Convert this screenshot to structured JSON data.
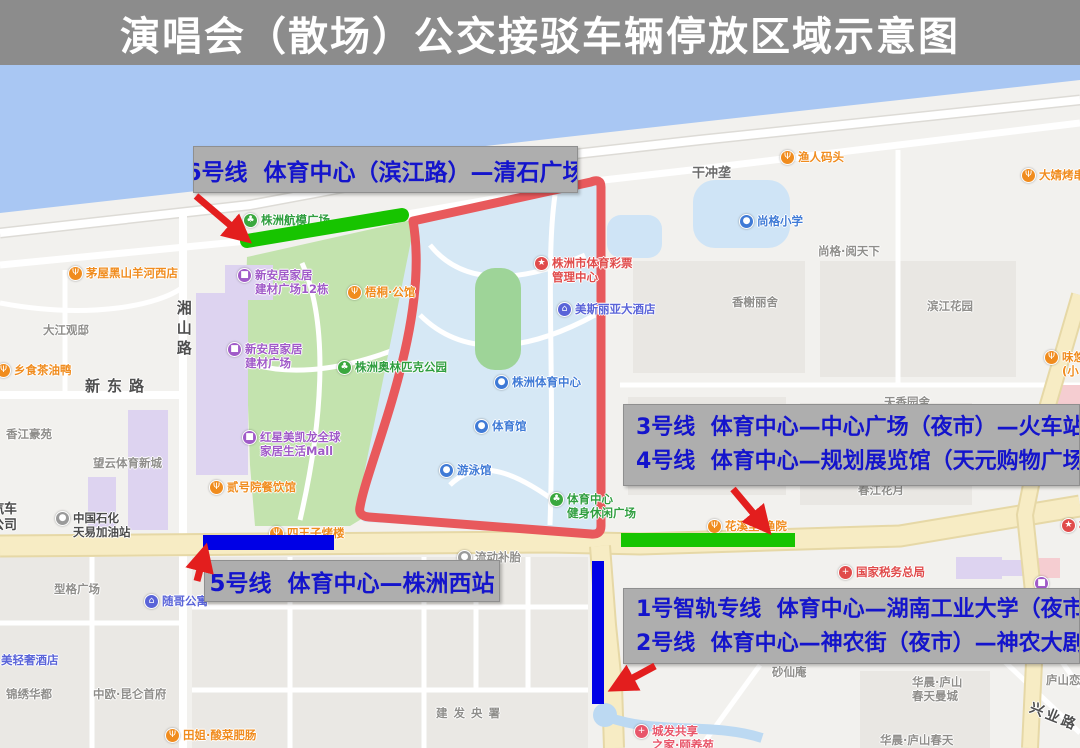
{
  "title": "演唱会（散场）公交接驳车辆停放区域示意图",
  "colors": {
    "title_bg": "#8c8c8c",
    "annotation_box_bg": "#aeaeae",
    "annotation_text": "#1414cc",
    "route_green": "#17c400",
    "route_blue": "#0000e6",
    "route_red_zone": "#e8595c",
    "arrow_red": "#e31e1e",
    "river_blue": "#a9c7f3",
    "park_green": "#c3e3ae",
    "stadium_blue": "#d6e8f5",
    "field_green": "#9ed498",
    "road_yellow": "#f7ecc4",
    "building_purple": "#ddd3f0",
    "building_pink": "#f5cdd1",
    "poi_orange": "#f08c1e",
    "poi_blue": "#3f7ad6",
    "poi_green": "#3aa83e",
    "poi_purple": "#a05ac8",
    "poi_red": "#e04b4b"
  },
  "annotations": {
    "line6": {
      "text": "6号线  体育中心（滨江路）—清石广场"
    },
    "line34": {
      "line1": "3号线  体育中心—中心广场（夜市）—火车站",
      "line2": "4号线  体育中心—规划展览馆（天元购物广场）"
    },
    "line5": {
      "text": "5号线  体育中心—株洲西站"
    },
    "line12": {
      "line1": "1号智轨专线  体育中心—湖南工业大学（夜市）",
      "line2": "2号线  体育中心—神农街（夜市）—神农大剧院"
    }
  },
  "map": {
    "labels": [
      {
        "n": "poi-aeromodel-plaza",
        "x": 243,
        "y": 148,
        "c": "#3aa83e",
        "g": "♣",
        "l": [
          "株洲航模广场"
        ],
        "tc": "#2f9e3f"
      },
      {
        "n": "poi-maowu-blackgoat-restaurant",
        "x": 68,
        "y": 201,
        "c": "#f08c1e",
        "g": "Ψ",
        "l": [
          "茅屋黑山羊河西店"
        ],
        "tc": "#f08c1e"
      },
      {
        "n": "poi-xiangshi-tea-oil-duck",
        "x": -4,
        "y": 298,
        "c": "#f08c1e",
        "g": "Ψ",
        "l": [
          "乡食茶油鸭"
        ],
        "tc": "#f08c1e"
      },
      {
        "n": "label-dajiang-guandi",
        "x": 43,
        "y": 258,
        "l": [
          "大江观邸"
        ],
        "tc": "#8f8e8b"
      },
      {
        "n": "label-xiangshan-road",
        "x": 174,
        "y": 235,
        "l": [
          "湘山路"
        ],
        "tc": "#4f4f4f",
        "fs": 15,
        "vert": true
      },
      {
        "n": "label-xindong-road",
        "x": 85,
        "y": 312,
        "l": [
          "新东路"
        ],
        "tc": "#4f4f4f",
        "fs": 15,
        "ls": 7
      },
      {
        "n": "poi-xinanju-12dong",
        "x": 237,
        "y": 203,
        "c": "#a05ac8",
        "g": "■",
        "l": [
          "新安居家居",
          "建材广场12栋"
        ],
        "tc": "#a05ac8"
      },
      {
        "n": "poi-wutong-mansion",
        "x": 347,
        "y": 220,
        "c": "#f08c1e",
        "g": "Ψ",
        "l": [
          "梧桐·公馆"
        ],
        "tc": "#f08c1e"
      },
      {
        "n": "poi-xinanju",
        "x": 227,
        "y": 277,
        "c": "#a05ac8",
        "g": "■",
        "l": [
          "新安居家居",
          "建材广场"
        ],
        "tc": "#a05ac8"
      },
      {
        "n": "poi-olympic-park",
        "x": 337,
        "y": 295,
        "c": "#3aa83e",
        "g": "♣",
        "l": [
          "株洲奥林匹克公园"
        ],
        "tc": "#2f9e3f"
      },
      {
        "n": "poi-macalline-mall",
        "x": 242,
        "y": 365,
        "c": "#a05ac8",
        "g": "■",
        "l": [
          "红星美凯龙全球",
          "家居生活Mall"
        ],
        "tc": "#a05ac8"
      },
      {
        "n": "poi-sports-lottery-center",
        "x": 534,
        "y": 191,
        "c": "#e04b4b",
        "g": "★",
        "l": [
          "株洲市体育彩票",
          "管理中心"
        ],
        "tc": "#e04b4b"
      },
      {
        "n": "poi-meisiliya-hotel",
        "x": 557,
        "y": 237,
        "c": "#5a64d8",
        "g": "⌂",
        "l": [
          "美斯丽亚大酒店"
        ],
        "tc": "#5a64d8"
      },
      {
        "n": "poi-zhuzhou-sports-center",
        "x": 494,
        "y": 310,
        "c": "#3f7ad6",
        "g": "●",
        "l": [
          "株洲体育中心"
        ],
        "tc": "#3f7ad6"
      },
      {
        "n": "poi-gymnasium",
        "x": 474,
        "y": 354,
        "c": "#3f7ad6",
        "g": "●",
        "l": [
          "体育馆"
        ],
        "tc": "#3f7ad6"
      },
      {
        "n": "poi-swimming-pool",
        "x": 439,
        "y": 398,
        "c": "#3f7ad6",
        "g": "●",
        "l": [
          "游泳馆"
        ],
        "tc": "#3f7ad6"
      },
      {
        "n": "poi-fitness-leisure-plaza",
        "x": 549,
        "y": 427,
        "c": "#3aa83e",
        "g": "♣",
        "l": [
          "体育中心",
          "健身休闲广场"
        ],
        "tc": "#2f9e3f"
      },
      {
        "n": "poi-siwangzi-restaurant",
        "x": 269,
        "y": 461,
        "c": "#f08c1e",
        "g": "Ψ",
        "l": [
          "四王子烤楼"
        ],
        "tc": "#f08c1e"
      },
      {
        "n": "poi-sinopec-gas-station",
        "x": 55,
        "y": 446,
        "c": "#9a9a9a",
        "g": "●",
        "l": [
          "中国石化",
          "天易加油站"
        ],
        "tc": "#4a4a4a"
      },
      {
        "n": "label-auto-company-partial",
        "x": -9,
        "y": 437,
        "l": [
          "汽车",
          "公司"
        ],
        "tc": "#4a4a4a",
        "fs": 13
      },
      {
        "n": "label-xiangjiang-haoyuan",
        "x": 6,
        "y": 362,
        "l": [
          "香江豪苑"
        ],
        "tc": "#8f8e8b"
      },
      {
        "n": "label-wangyun-sports-town",
        "x": 93,
        "y": 391,
        "l": [
          "望云体育新城"
        ],
        "tc": "#8f8e8b"
      },
      {
        "n": "poi-erhaoyuan-restaurant",
        "x": 209,
        "y": 415,
        "c": "#f08c1e",
        "g": "Ψ",
        "l": [
          "贰号院餐饮馆"
        ],
        "tc": "#f08c1e"
      },
      {
        "n": "label-xingge-plaza",
        "x": 54,
        "y": 517,
        "l": [
          "型格广场"
        ],
        "tc": "#8f8e8b"
      },
      {
        "n": "poi-suige-apartment",
        "x": 144,
        "y": 529,
        "c": "#5a64d8",
        "g": "⌂",
        "l": [
          "随哥公寓"
        ],
        "tc": "#5a64d8"
      },
      {
        "n": "label-meiqingshe-hotel",
        "x": 1,
        "y": 588,
        "l": [
          "美轻奢酒店"
        ],
        "tc": "#5a64d8"
      },
      {
        "n": "label-jinxiu-huadu",
        "x": 6,
        "y": 622,
        "l": [
          "锦绣华都"
        ],
        "tc": "#8f8e8b"
      },
      {
        "n": "label-zhongou-kunlun",
        "x": 93,
        "y": 622,
        "l": [
          "中欧·昆仑首府"
        ],
        "tc": "#8f8e8b"
      },
      {
        "n": "poi-tianjie-restaurant",
        "x": 165,
        "y": 663,
        "c": "#f08c1e",
        "g": "Ψ",
        "l": [
          "田姐·酸菜肥肠"
        ],
        "tc": "#f08c1e"
      },
      {
        "n": "label-jianfa-yangshu",
        "x": 436,
        "y": 641,
        "l": [
          "建发央署"
        ],
        "tc": "#8f8e8b",
        "ls": 6
      },
      {
        "n": "poi-mobile-tire-repair",
        "x": 457,
        "y": 485,
        "c": "#9a9a9a",
        "g": "●",
        "l": [
          "流动补胎"
        ],
        "tc": "#8f8e8b"
      },
      {
        "n": "poi-fisherman-wharf",
        "x": 780,
        "y": 85,
        "c": "#f08c1e",
        "g": "Ψ",
        "l": [
          "渔人码头"
        ],
        "tc": "#f08c1e"
      },
      {
        "n": "label-ganchonglong",
        "x": 692,
        "y": 101,
        "l": [
          "干冲垄"
        ],
        "tc": "#6a6a6a",
        "fs": 13
      },
      {
        "n": "poi-shangge-primary-school",
        "x": 739,
        "y": 149,
        "c": "#3f7ad6",
        "g": "●",
        "l": [
          "尚格小学"
        ],
        "tc": "#3f7ad6"
      },
      {
        "n": "label-shangge-yuetianxia",
        "x": 818,
        "y": 179,
        "l": [
          "尚格·阅天下"
        ],
        "tc": "#8f8e8b"
      },
      {
        "n": "poi-dajing-bbq",
        "x": 1021,
        "y": 103,
        "c": "#f08c1e",
        "g": "Ψ",
        "l": [
          "大婧烤串"
        ],
        "tc": "#f08c1e"
      },
      {
        "n": "label-xiangxie-lishe",
        "x": 732,
        "y": 230,
        "l": [
          "香榭丽舍"
        ],
        "tc": "#8f8e8b"
      },
      {
        "n": "label-binjiang-garden",
        "x": 927,
        "y": 234,
        "l": [
          "滨江花园"
        ],
        "tc": "#8f8e8b"
      },
      {
        "n": "poi-weiyou-snack",
        "x": 1044,
        "y": 285,
        "c": "#f08c1e",
        "g": "Ψ",
        "l": [
          "味悠",
          "(小"
        ],
        "tc": "#f08c1e"
      },
      {
        "n": "label-chunjiang-huayue",
        "x": 858,
        "y": 418,
        "l": [
          "春江花月"
        ],
        "tc": "#8f8e8b"
      },
      {
        "n": "poi-huaxili-yuyuan",
        "x": 707,
        "y": 454,
        "c": "#f08c1e",
        "g": "Ψ",
        "l": [
          "花溪里.渔院"
        ],
        "tc": "#f08c1e"
      },
      {
        "n": "poi-national-tax-bureau",
        "x": 838,
        "y": 500,
        "c": "#e04b4b",
        "g": "+",
        "l": [
          "国家税务总局"
        ],
        "tc": "#e04b4b"
      },
      {
        "n": "poi-purple-hidden",
        "x": 1034,
        "y": 511,
        "c": "#a05ac8",
        "g": "■",
        "l": []
      },
      {
        "n": "poi-chengfa-nursing-home",
        "x": 634,
        "y": 659,
        "c": "#e8566a",
        "g": "+",
        "l": [
          "城发共享",
          "之家·颐养苑"
        ],
        "tc": "#e8566a"
      },
      {
        "n": "label-huachen-lushan-mancheng",
        "x": 912,
        "y": 610,
        "l": [
          "华晨·庐山",
          "春天曼城"
        ],
        "tc": "#8f8e8b"
      },
      {
        "n": "label-lushan-lian",
        "x": 1046,
        "y": 608,
        "l": [
          "庐山恋"
        ],
        "tc": "#8f8e8b"
      },
      {
        "n": "label-xingye-road",
        "x": 1028,
        "y": 644,
        "l": [
          "兴业路"
        ],
        "tc": "#4f4f4f",
        "fs": 14,
        "rot": 22,
        "ls": 3
      },
      {
        "n": "label-huachen-lushan-chuntian",
        "x": 880,
        "y": 668,
        "l": [
          "华晨·庐山春天"
        ],
        "tc": "#8f8e8b"
      },
      {
        "n": "label-shaxian-an",
        "x": 772,
        "y": 600,
        "l": [
          "砂仙庵"
        ],
        "tc": "#8f8e8b"
      },
      {
        "n": "label-tianxiang-partial",
        "x": 884,
        "y": 330,
        "l": [
          "天香园舍"
        ],
        "tc": "#8f8e8b"
      },
      {
        "n": "poi-star-right-edge",
        "x": 1061,
        "y": 453,
        "c": "#e04b4b",
        "g": "★",
        "l": [
          "株"
        ],
        "tc": "#e04b4b"
      }
    ]
  }
}
